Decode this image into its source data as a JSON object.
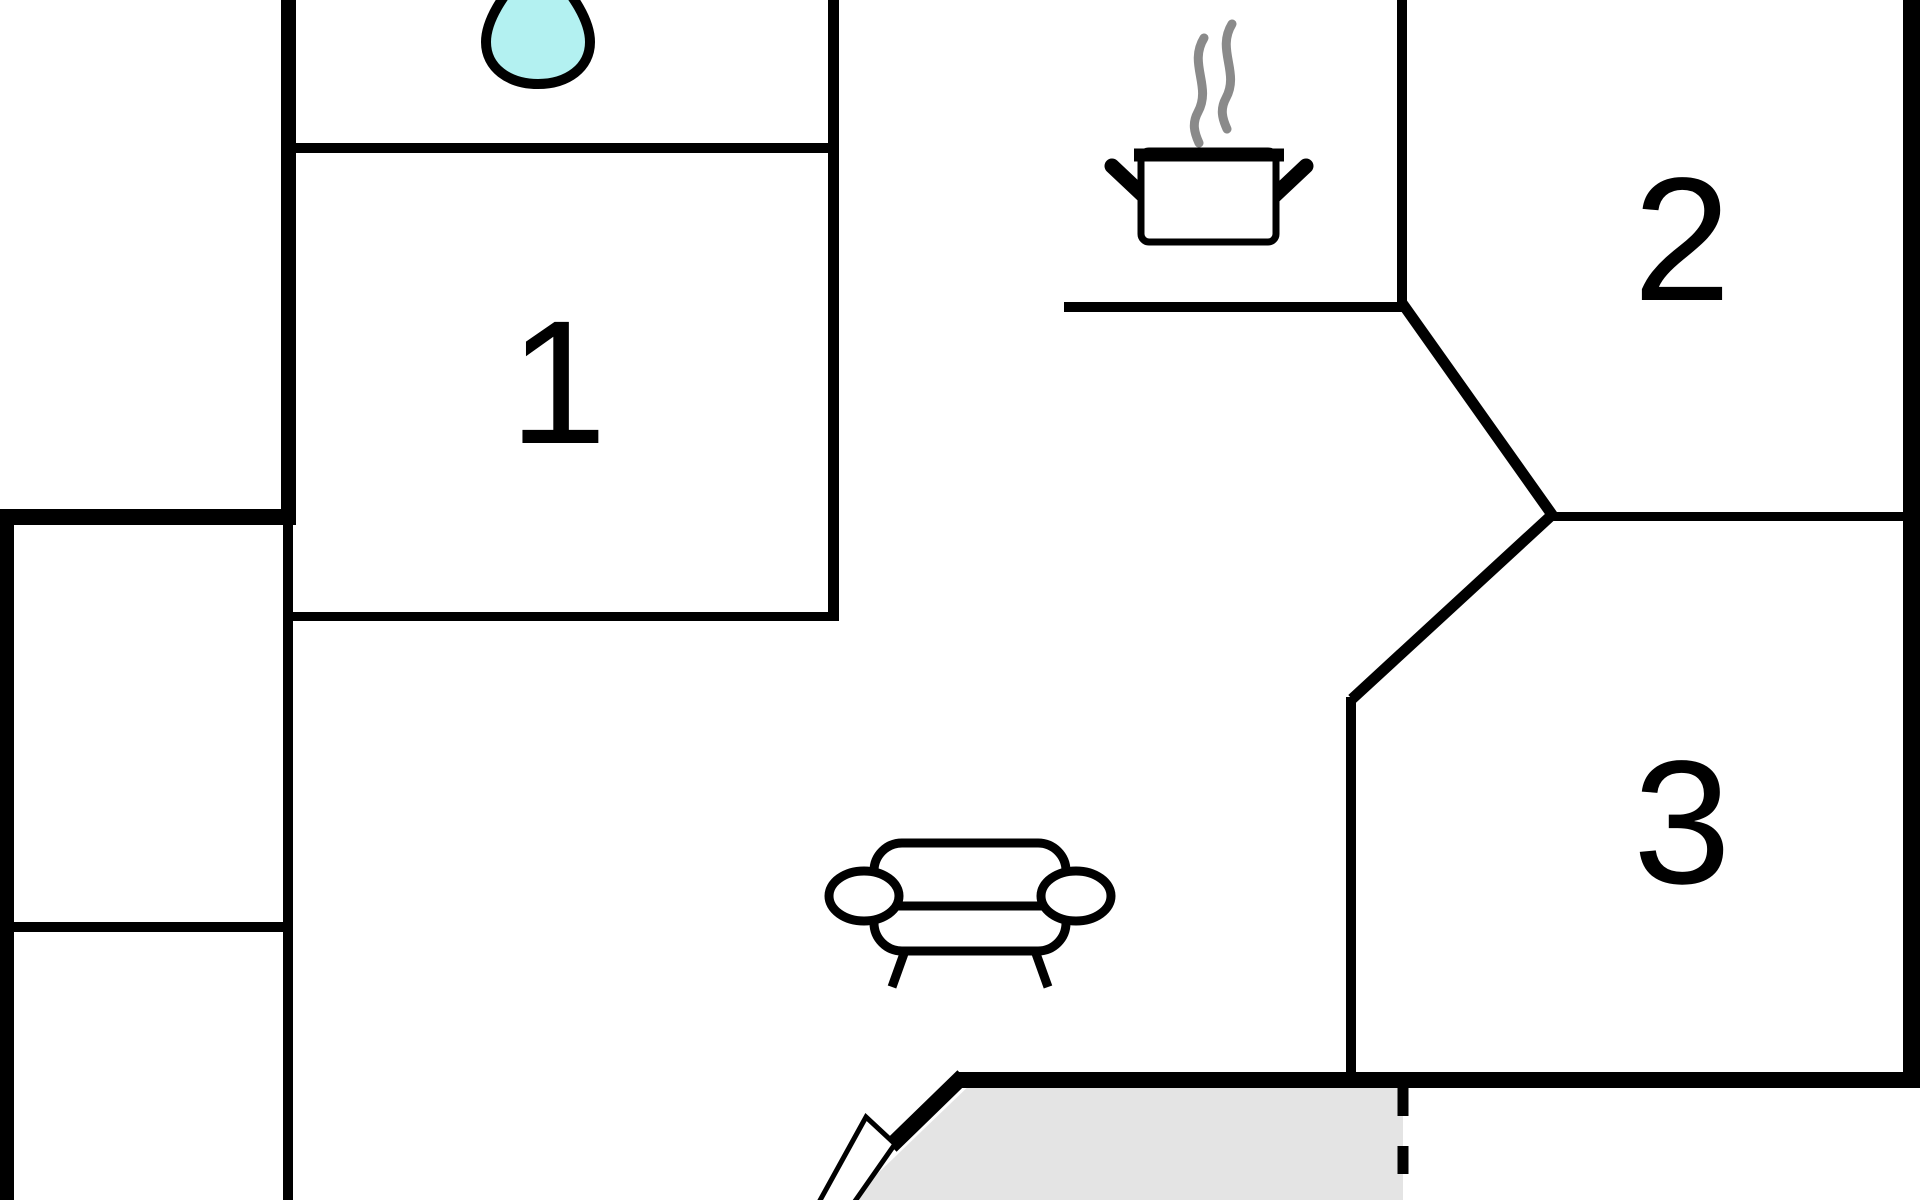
{
  "floor_plan": {
    "type": "floor-plan",
    "rooms": [
      {
        "id": "room-1",
        "label": "1"
      },
      {
        "id": "room-2",
        "label": "2"
      },
      {
        "id": "room-3",
        "label": "3"
      }
    ],
    "icons": [
      {
        "name": "water-drop-icon"
      },
      {
        "name": "steam-icon"
      },
      {
        "name": "cooking-pot-icon"
      },
      {
        "name": "sofa-icon"
      },
      {
        "name": "door-icon"
      }
    ]
  },
  "colors": {
    "wall": "#000000",
    "label": "#000000",
    "background": "#ffffff",
    "water_drop_fill": "#b3f1f1",
    "steam": "#8a8a8a",
    "terrace_fill": "#e4e4e4",
    "door_fill": "#ffffff"
  }
}
